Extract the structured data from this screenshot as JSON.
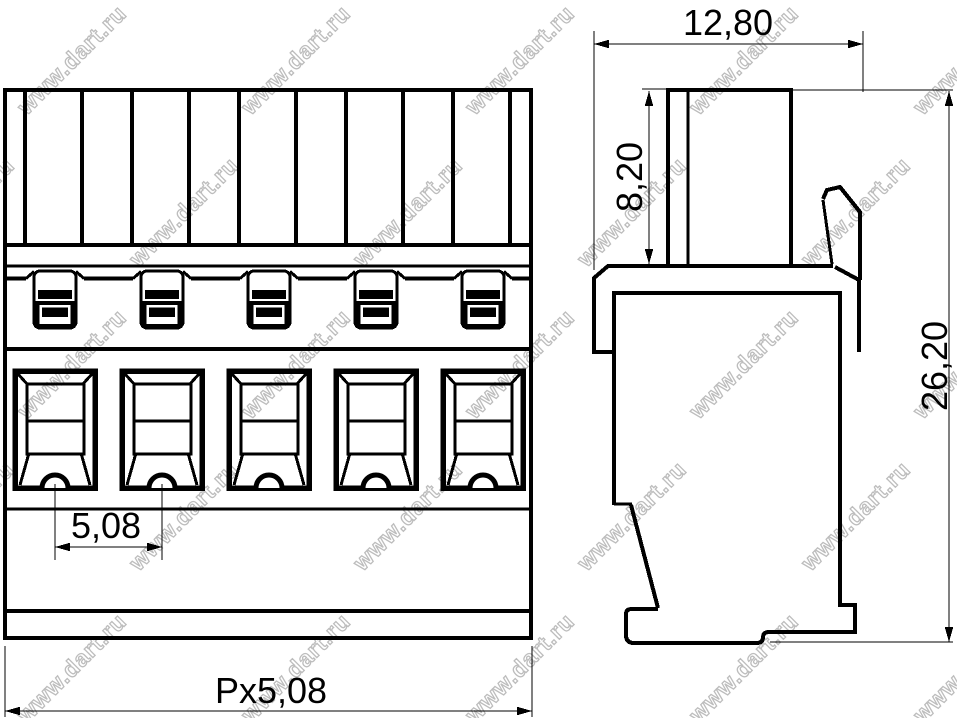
{
  "drawing": {
    "watermark_text": "www.dart.ru",
    "background_color": "#ffffff",
    "line_color": "#000000",
    "watermark_color": "#bdbdbd",
    "front_view": {
      "positions": 5
    },
    "dimensions": {
      "pitch": "5,08",
      "total_width": "Px5,08",
      "housing_width": "12,80",
      "actuator_height": "8,20",
      "total_height": "26,20"
    }
  }
}
